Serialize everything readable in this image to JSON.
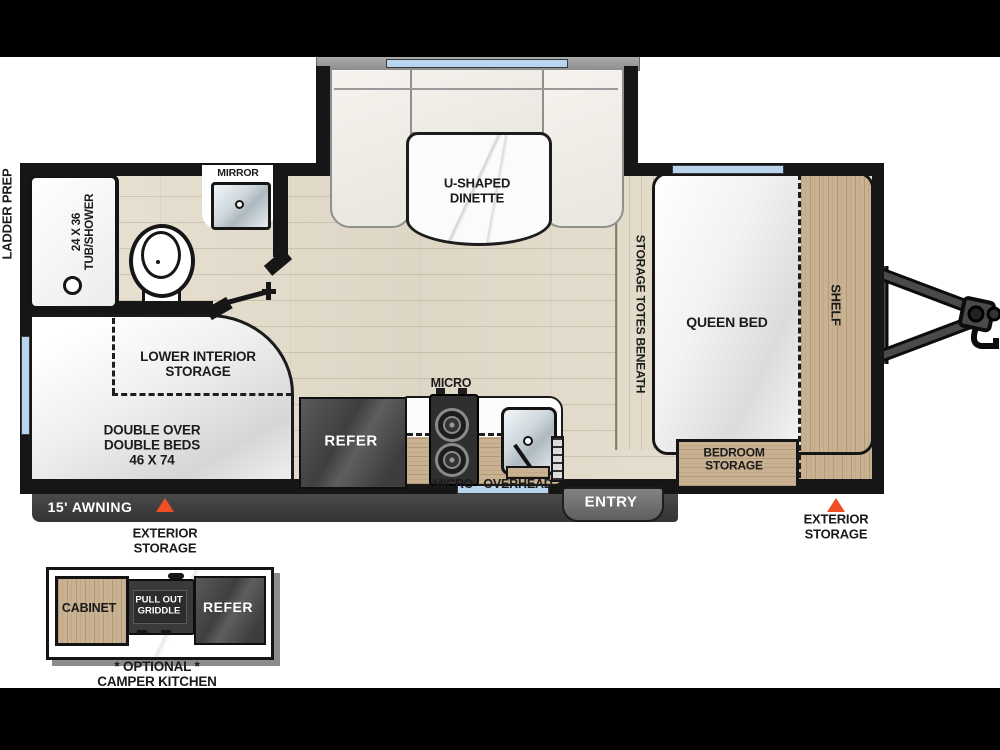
{
  "dinette": {
    "label_lines": [
      "U-SHAPED",
      "DINETTE"
    ]
  },
  "bedroom": {
    "queen_bed": "QUEEN BED",
    "shelf": "SHELF",
    "storage_totes": "STORAGE TOTES BENEATH",
    "storage_lines": [
      "BEDROOM",
      "STORAGE"
    ]
  },
  "bathroom": {
    "mirror": "MIRROR",
    "tub_lines": [
      "24 X 36",
      "TUB/SHOWER"
    ]
  },
  "bunk": {
    "interior_storage_lines": [
      "LOWER INTERIOR",
      "STORAGE"
    ],
    "beds_lines": [
      "DOUBLE OVER",
      "DOUBLE BEDS",
      "46 X 74"
    ]
  },
  "kitchen": {
    "refer": "REFER",
    "micro_top": "MICRO",
    "micro_bottom": "MICRO",
    "overhead": "OVERHEAD"
  },
  "exterior": {
    "ladder_prep": "LADDER PREP",
    "awning": "15' AWNING",
    "entry": "ENTRY",
    "storage_left_lines": [
      "EXTERIOR",
      "STORAGE"
    ],
    "storage_right_lines": [
      "EXTERIOR",
      "STORAGE"
    ]
  },
  "camper_kitchen": {
    "cabinet": "CABINET",
    "griddle_lines": [
      "PULL OUT",
      "GRIDDLE"
    ],
    "refer": "REFER",
    "caption_lines": [
      "* OPTIONAL *",
      "CAMPER KITCHEN"
    ]
  },
  "colors": {
    "accent_orange": "#f04f23",
    "window_blue": "#b9d4ee",
    "wall_black": "#161616",
    "wood_tan": "#c9b292",
    "floor_beige": "#e5decf"
  }
}
